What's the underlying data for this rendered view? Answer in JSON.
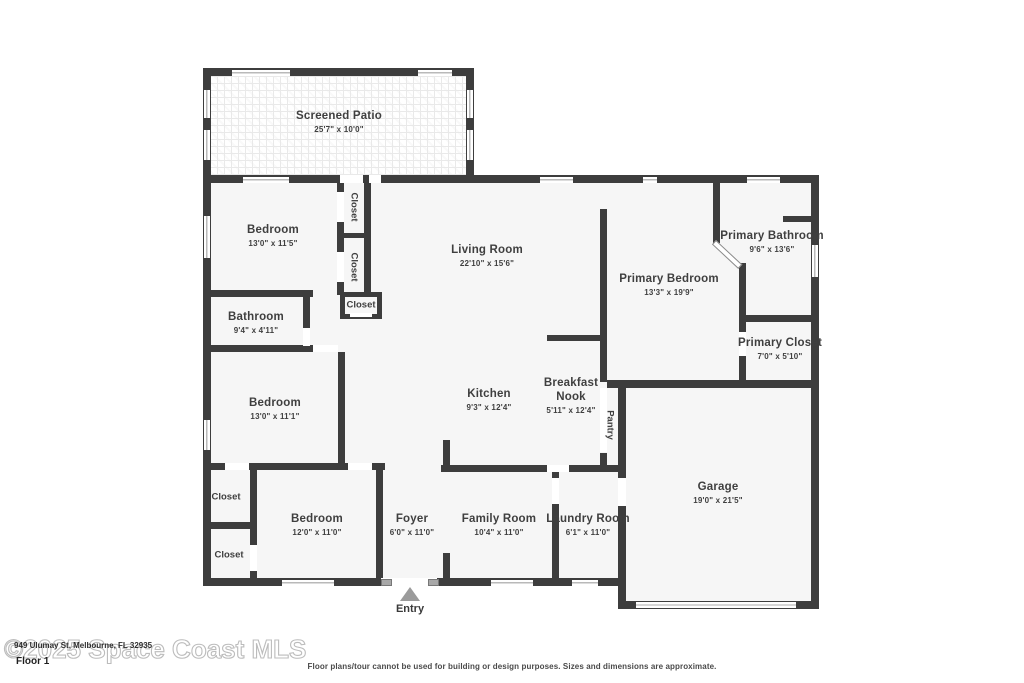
{
  "plan": {
    "rooms": [
      {
        "name": "Screened Patio",
        "dims": "25'7\" x 10'0\""
      },
      {
        "name": "Bedroom",
        "dims": "13'0\" x 11'5\""
      },
      {
        "name": "Living Room",
        "dims": "22'10\" x 15'6\""
      },
      {
        "name": "Primary Bathroom",
        "dims": "9'6\" x 13'6\""
      },
      {
        "name": "Primary Bedroom",
        "dims": "13'3\" x 19'9\""
      },
      {
        "name": "Bathroom",
        "dims": "9'4\" x 4'11\""
      },
      {
        "name": "Primary Closet",
        "dims": "7'0\" x 5'10\""
      },
      {
        "name": "Bedroom",
        "dims": "13'0\" x 11'1\""
      },
      {
        "name": "Kitchen",
        "dims": "9'3\" x 12'4\""
      },
      {
        "name": "Breakfast Nook",
        "dims": "5'11\" x 12'4\""
      },
      {
        "name": "Garage",
        "dims": "19'0\" x 21'5\""
      },
      {
        "name": "Bedroom",
        "dims": "12'0\" x 11'0\""
      },
      {
        "name": "Foyer",
        "dims": "6'0\" x 11'0\""
      },
      {
        "name": "Family Room",
        "dims": "10'4\" x 11'0\""
      },
      {
        "name": "Laundry Room",
        "dims": "6'1\" x 11'0\""
      }
    ],
    "closet_labels": [
      "Closet",
      "Closet",
      "Closet",
      "Closet",
      "Closet"
    ],
    "pantry_label": "Pantry",
    "entry_label": "Entry"
  },
  "footer": {
    "floor_label": "Floor 1",
    "watermark": "©2025 Space Coast MLS",
    "address_overlay": "949 Ulumay St, Melbourne, FL 32935",
    "disclaimer": "Floor plans/tour cannot be used for building or design purposes. Sizes and dimensions are approximate."
  },
  "colors": {
    "wall": "#3d3d3d",
    "room_fill": "#f6f6f6",
    "entry_marker": "#9b9b9b",
    "watermark": "#bdbdbd"
  }
}
